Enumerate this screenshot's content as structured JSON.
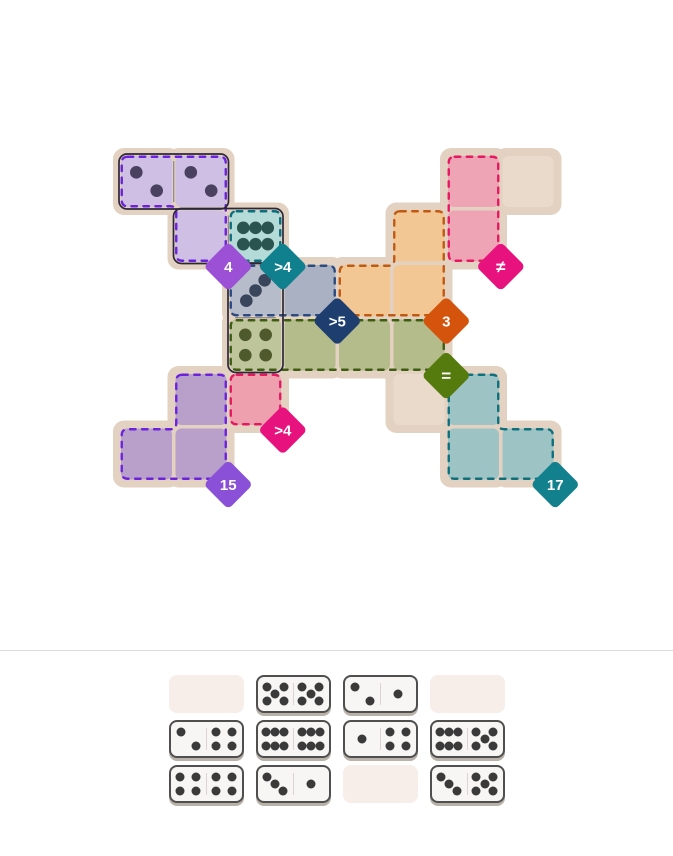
{
  "title": "Domino pips puzzle",
  "board": {
    "regions": [
      {
        "name": "purple-top",
        "fill": "#c8b5e0",
        "stroke": "#6c22dc",
        "cells": [
          [
            0,
            0
          ],
          [
            1,
            0
          ],
          [
            1,
            1
          ]
        ],
        "badge": {
          "label": "4",
          "color": "#9b50d6",
          "at": [
            1,
            1
          ]
        }
      },
      {
        "name": "teal-top",
        "fill": "#a9d6d2",
        "stroke": "#0c6d7c",
        "cells": [
          [
            2,
            1
          ]
        ],
        "badge": {
          "label": ">4",
          "color": "#11808e",
          "at": [
            2,
            1
          ]
        }
      },
      {
        "name": "slate-blue",
        "fill": "#aab1c2",
        "stroke": "#2a4a80",
        "cells": [
          [
            2,
            2
          ],
          [
            3,
            2
          ]
        ],
        "badge": {
          "label": ">5",
          "color": "#1d3e6e",
          "at": [
            3,
            2
          ]
        }
      },
      {
        "name": "orange",
        "fill": "#f2c793",
        "stroke": "#c15a11",
        "cells": [
          [
            5,
            1
          ],
          [
            4,
            2
          ],
          [
            5,
            2
          ]
        ],
        "badge": {
          "label": "3",
          "color": "#d4540d",
          "at": [
            5,
            2
          ]
        }
      },
      {
        "name": "pink-top",
        "fill": "#efa4b6",
        "stroke": "#e41960",
        "cells": [
          [
            6,
            0
          ],
          [
            6,
            1
          ]
        ],
        "badge": {
          "label": "≠",
          "color": "#e8127e",
          "at": [
            6,
            1
          ]
        }
      },
      {
        "name": "green",
        "fill": "#b5bc8b",
        "stroke": "#3e5c12",
        "cells": [
          [
            2,
            3
          ],
          [
            3,
            3
          ],
          [
            4,
            3
          ],
          [
            5,
            3
          ]
        ],
        "badge": {
          "label": "=",
          "color": "#557a0d",
          "at": [
            5,
            3
          ]
        }
      },
      {
        "name": "purple-bottom",
        "fill": "#b8a0ca",
        "stroke": "#6d23dd",
        "cells": [
          [
            1,
            4
          ],
          [
            0,
            5
          ],
          [
            1,
            5
          ]
        ],
        "badge": {
          "label": "15",
          "color": "#8a50d8",
          "at": [
            1,
            5
          ]
        }
      },
      {
        "name": "pink-bottom",
        "fill": "#efa0ae",
        "stroke": "#e41960",
        "cells": [
          [
            2,
            4
          ]
        ],
        "badge": {
          "label": ">4",
          "color": "#e8127e",
          "at": [
            2,
            4
          ]
        }
      },
      {
        "name": "teal-bottom",
        "fill": "#9dc3c5",
        "stroke": "#0e6f7d",
        "cells": [
          [
            6,
            4
          ],
          [
            6,
            5
          ],
          [
            7,
            5
          ]
        ],
        "badge": {
          "label": "17",
          "color": "#12808d",
          "at": [
            7,
            5
          ]
        }
      }
    ],
    "plain_cells": [
      [
        7,
        0
      ],
      [
        5,
        4
      ]
    ],
    "placed_dominoes": [
      {
        "pips": [
          2,
          2
        ],
        "cells": [
          [
            0,
            0
          ],
          [
            1,
            0
          ]
        ],
        "pip_colors": [
          "#4a4160",
          "#4a4160"
        ]
      },
      {
        "pips": [
          0,
          6
        ],
        "cells": [
          [
            1,
            1
          ],
          [
            2,
            1
          ]
        ],
        "pip_colors": [
          "#4a4160",
          "#2a5450"
        ]
      },
      {
        "pips": [
          3,
          4
        ],
        "cells": [
          [
            2,
            2
          ],
          [
            2,
            3
          ]
        ],
        "pip_colors": [
          "#39455a",
          "#4e5a2c"
        ]
      }
    ]
  },
  "tray": {
    "rows": [
      [
        null,
        [
          5,
          5
        ],
        [
          2,
          1
        ],
        null
      ],
      [
        [
          2,
          4
        ],
        [
          6,
          6
        ],
        [
          1,
          4
        ],
        [
          6,
          5
        ]
      ],
      [
        [
          4,
          4
        ],
        [
          3,
          1
        ],
        null,
        [
          3,
          5
        ]
      ]
    ]
  },
  "colors": {
    "page_bg": "#ffffff",
    "board_base": "#e3d1c1",
    "plain_cell": "#e9dacc",
    "covered_lighten": "rgba(255,255,255,0.14)",
    "divider": "#dcdcdc",
    "tile_bg": "#f7f6f4",
    "tile_border": "#4f4f4f",
    "tile_shadow": "#b9b2a9",
    "pip": "#3a3a3a",
    "empty_slot": "#f7eeea",
    "domino_outline": "#2c2838",
    "domino_divider": "#7a7386",
    "badge_text": "#ffffff"
  }
}
